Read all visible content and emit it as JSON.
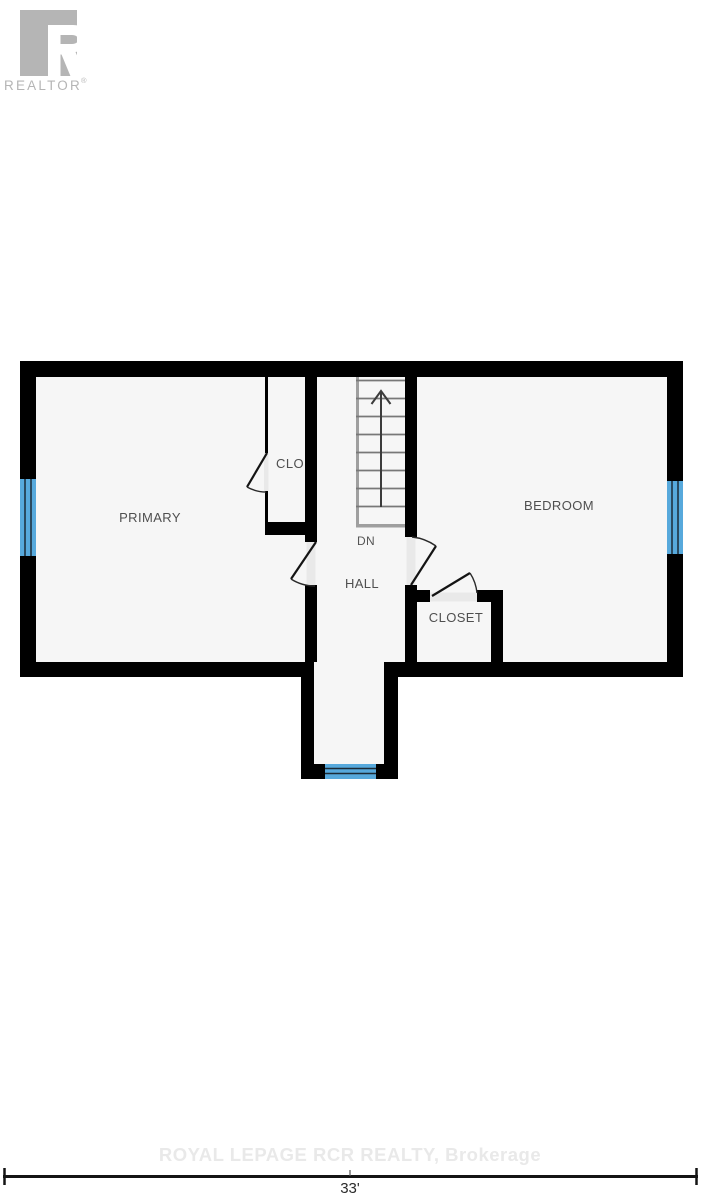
{
  "branding": {
    "logo_letter": "R",
    "logo_text": "REALTOR",
    "logo_registered": "®"
  },
  "floor_plan": {
    "level": "second-floor",
    "room_labels": {
      "primary": "PRIMARY",
      "clo": "CLO",
      "bedroom": "BEDROOM",
      "hall": "HALL",
      "closet": "CLOSET"
    },
    "stairs": {
      "direction_label": "DN",
      "step_count": 8
    },
    "window_count": 3
  },
  "watermark": {
    "text": "ROYAL LEPAGE RCR REALTY, Brokerage"
  },
  "dimension": {
    "overall_width": "33'"
  },
  "colors": {
    "wall": "#000000",
    "room_fill": "#f6f6f6",
    "window_blue": "#57a9dc",
    "door_fill": "#e9e9e9",
    "label_gray": "#4f4f4f",
    "logo_gray": "#b5b5b5",
    "watermark_gray": "#e9e9e9",
    "dimension_line": "#141414"
  }
}
